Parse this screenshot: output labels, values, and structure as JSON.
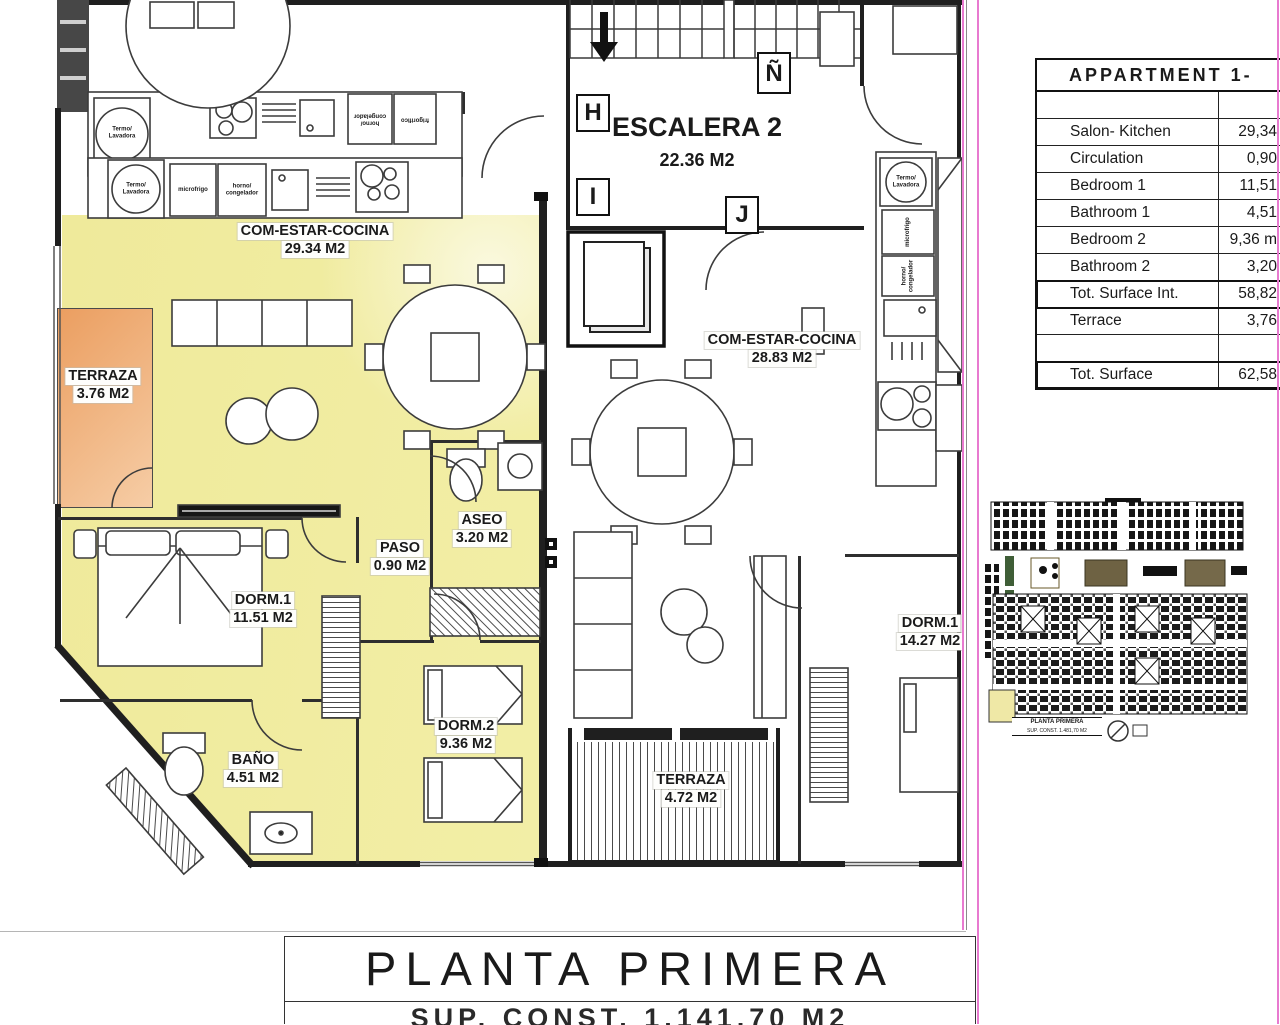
{
  "plan": {
    "grid_markers": {
      "m1": "H",
      "m2": "I",
      "m3": "J",
      "m4": "Ñ"
    },
    "stair": {
      "name": "ESCALERA 2",
      "area": "22.36 M2"
    },
    "left_unit": {
      "living": {
        "name": "COM-ESTAR-COCINA",
        "area": "29.34 M2"
      },
      "terrace": {
        "name": "TERRAZA",
        "area": "3.76 M2"
      },
      "bedroom1": {
        "name": "DORM.1",
        "area": "11.51 M2"
      },
      "bathroom": {
        "name": "BAÑO",
        "area": "4.51 M2"
      },
      "bedroom2": {
        "name": "DORM.2",
        "area": "9.36 M2"
      },
      "hall": {
        "name": "PASO",
        "area": "0.90 M2"
      },
      "toilet": {
        "name": "ASEO",
        "area": "3.20 M2"
      }
    },
    "right_unit": {
      "living": {
        "name": "COM-ESTAR-COCINA",
        "area": "28.83 M2"
      },
      "bedroom1": {
        "name": "DORM.1",
        "area": "14.27 M2"
      },
      "terrace": {
        "name": "TERRAZA",
        "area": "4.72 M2"
      }
    },
    "appliance_labels": {
      "boiler_washer": "Termo/\nLavadora",
      "micro_fridge": "microfrigo",
      "oven_freezer": "horno/\ncongelador",
      "fridge": "frigorifico"
    }
  },
  "area_table": {
    "title": "APPARTMENT 1-",
    "rows": [
      {
        "label": "Salon- Kitchen",
        "value": "29,34"
      },
      {
        "label": "Circulation",
        "value": "0,90"
      },
      {
        "label": "Bedroom 1",
        "value": "11,51"
      },
      {
        "label": "Bathroom 1",
        "value": "4,51"
      },
      {
        "label": "Bedroom 2",
        "value": "9,36 m"
      },
      {
        "label": "Bathroom 2",
        "value": "3,20"
      },
      {
        "label": "Tot. Surface Int.",
        "value": "58,82"
      },
      {
        "label": "Terrace",
        "value": "3,76"
      },
      {
        "label": "Tot. Surface",
        "value": "62,58"
      }
    ]
  },
  "key_plan": {
    "caption_line1": "PLANTA PRIMERA",
    "caption_line2": "SUP. CONST. 1.481,70 M2"
  },
  "title_block": {
    "title": "PLANTA PRIMERA",
    "subtitle_clipped": "SUP. CONST. 1.141,70 M2"
  },
  "colors": {
    "highlight_yellow": "#f2eea2",
    "terrace_orange": "#eda368",
    "boundary_pink": "#e87ad0"
  }
}
